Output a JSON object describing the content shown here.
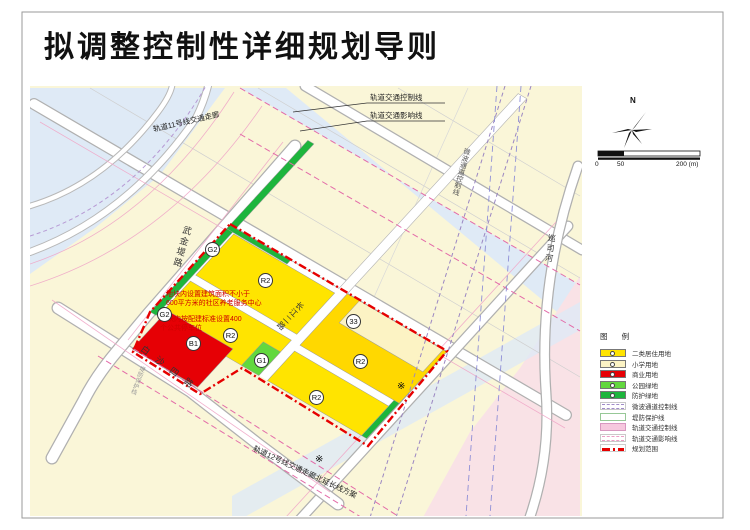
{
  "title": "拟调整控制性详细规划导则",
  "map": {
    "roads": {
      "wujindi": "武金堤路",
      "baishasi": "白沙四路",
      "changjianger": "长江二路",
      "xunsihe": "巡司河"
    },
    "corridors": {
      "rail_control": "轨道交通控制线",
      "rail_influence": "轨道交通影响线",
      "rail11": "轨道11号线交通走廊",
      "rail12": "轨道12号线交通走廊北延长线方案",
      "microwave": "微波通道控制线",
      "dike": "堤防保护线"
    },
    "notes": {
      "note1_line1": "地块内设置建筑面积不小于",
      "note1_line2": "600平方米的社区养老服务中心",
      "note2_line1": "地块内按配建标准设置400",
      "note2_line2": "个公共停车位"
    },
    "parcel_labels": [
      {
        "code": "G2"
      },
      {
        "code": "G2"
      },
      {
        "code": "R2"
      },
      {
        "code": "R2"
      },
      {
        "code": "R2"
      },
      {
        "code": "R2"
      },
      {
        "code": "B1"
      },
      {
        "code": "G1"
      },
      {
        "code": "33"
      }
    ],
    "star": "※"
  },
  "north": {
    "label": "N"
  },
  "scalebar": {
    "t0": "0",
    "t50": "50",
    "t200": "200 (m)"
  },
  "legend": {
    "title": "图  例",
    "items": [
      {
        "label": "二类居住用地",
        "type": "fill",
        "color": "#ffe400"
      },
      {
        "label": "小学用地",
        "type": "fill",
        "color": "#fcf3c4"
      },
      {
        "label": "商业用地",
        "type": "fill",
        "color": "#e60005"
      },
      {
        "label": "公园绿地",
        "type": "fill",
        "color": "#62d83e"
      },
      {
        "label": "防护绿地",
        "type": "fill",
        "color": "#1db53c"
      },
      {
        "label": "微波通道控制线",
        "type": "dash",
        "color": "#a08cc8"
      },
      {
        "label": "堤防保护线",
        "type": "outline",
        "color": "#97c897"
      },
      {
        "label": "轨道交通控制线",
        "type": "fill",
        "color": "#f6c8de"
      },
      {
        "label": "轨道交通影响线",
        "type": "dash",
        "color": "#ec9ec6"
      },
      {
        "label": "规划范围",
        "type": "dashdot",
        "color": "#e60000"
      }
    ]
  }
}
